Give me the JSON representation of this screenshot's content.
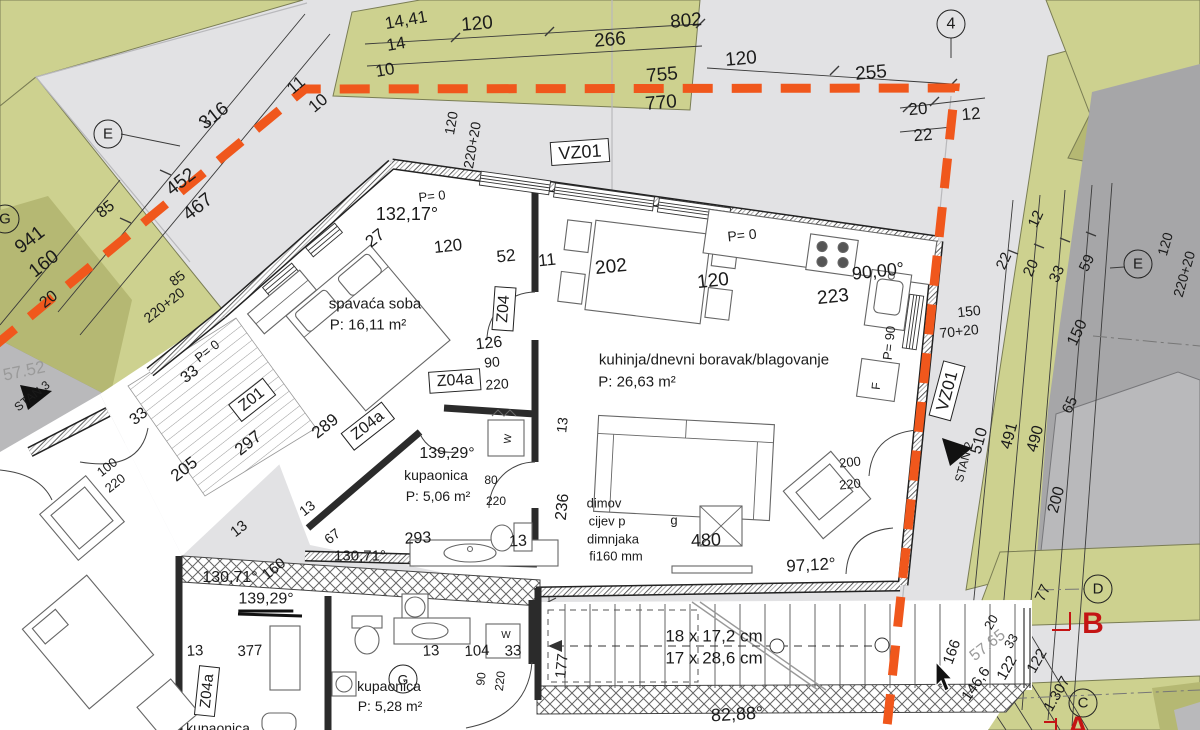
{
  "meta": {
    "drawing_type": "architectural floor plan",
    "cursor_visible": true
  },
  "colors": {
    "boundary_orange": "#f0571c",
    "site_green": "#cdd18f",
    "site_green_dark": "#b5b873",
    "road_dark": "#a6a6a8",
    "building_gray": "#b9b9bb",
    "section_red": "#c41414",
    "paper_gray": "#e2e2e4"
  },
  "rooms": [
    {
      "name": "spavaća soba",
      "area": "P: 16,11 m²"
    },
    {
      "name": "kuhinja/dnevni boravak/blagovanje",
      "area": "P: 26,63 m²"
    },
    {
      "name": "kupaonica",
      "area": "P: 5,06 m²"
    },
    {
      "name": "kupaonica",
      "area": "P: 5,28 m²"
    }
  ],
  "stairs_note": {
    "risers": "18 x 17,2 cm",
    "treads": "17 x 28,6 cm"
  },
  "labels": [
    {
      "id": "dim-14-41",
      "t": "14,41",
      "x": 406,
      "y": 20,
      "r": -10,
      "s": 17
    },
    {
      "id": "dim-14",
      "t": "14",
      "x": 396,
      "y": 44,
      "r": -10,
      "s": 17
    },
    {
      "id": "dim-10-a",
      "t": "10",
      "x": 385,
      "y": 70,
      "r": -10,
      "s": 17
    },
    {
      "id": "dim-10-b",
      "t": "10",
      "x": 318,
      "y": 103,
      "r": -40,
      "s": 17
    },
    {
      "id": "dim-11-a",
      "t": "11",
      "x": 296,
      "y": 85,
      "r": -40,
      "s": 17
    },
    {
      "id": "dim-120-a",
      "t": "120",
      "x": 477,
      "y": 24,
      "r": -5,
      "s": 19
    },
    {
      "id": "dim-266",
      "t": "266",
      "x": 610,
      "y": 40,
      "r": -5,
      "s": 19
    },
    {
      "id": "dim-802",
      "t": "802",
      "x": 686,
      "y": 21,
      "r": -5,
      "s": 19
    },
    {
      "id": "dim-755",
      "t": "755",
      "x": 662,
      "y": 75,
      "r": -5,
      "s": 19
    },
    {
      "id": "dim-770",
      "t": "770",
      "x": 661,
      "y": 103,
      "r": -5,
      "s": 19
    },
    {
      "id": "dim-120-b",
      "t": "120",
      "x": 741,
      "y": 59,
      "r": -5,
      "s": 19
    },
    {
      "id": "dim-255",
      "t": "255",
      "x": 871,
      "y": 73,
      "r": -5,
      "s": 19
    },
    {
      "id": "dim-20-a",
      "t": "20",
      "x": 918,
      "y": 109,
      "r": -5,
      "s": 17
    },
    {
      "id": "dim-12-a",
      "t": "12",
      "x": 971,
      "y": 114,
      "r": -5,
      "s": 17
    },
    {
      "id": "dim-22-a",
      "t": "22",
      "x": 923,
      "y": 135,
      "r": -5,
      "s": 17
    },
    {
      "id": "grid-4",
      "t": "4",
      "x": 951,
      "y": 24,
      "r": 0,
      "s": 16,
      "st": "circ"
    },
    {
      "id": "vz01-top",
      "t": "VZ01",
      "x": 580,
      "y": 152,
      "r": -4,
      "s": 18,
      "st": "box"
    },
    {
      "id": "dim-120-rot-a",
      "t": "120",
      "x": 451,
      "y": 123,
      "r": -80,
      "s": 14
    },
    {
      "id": "dim-220-20-a",
      "t": "220+20",
      "x": 472,
      "y": 145,
      "r": -80,
      "s": 14
    },
    {
      "id": "dim-120-rot-b",
      "t": "120",
      "x": 1165,
      "y": 244,
      "r": -74,
      "s": 14
    },
    {
      "id": "dim-220-20-b",
      "t": "220+20",
      "x": 1184,
      "y": 274,
      "r": -74,
      "s": 14
    },
    {
      "id": "dim-316",
      "t": "316",
      "x": 214,
      "y": 116,
      "r": -38,
      "s": 19
    },
    {
      "id": "dim-452",
      "t": "452",
      "x": 181,
      "y": 182,
      "r": -38,
      "s": 19
    },
    {
      "id": "dim-467",
      "t": "467",
      "x": 198,
      "y": 207,
      "r": -38,
      "s": 19
    },
    {
      "id": "dim-85-a",
      "t": "85",
      "x": 106,
      "y": 210,
      "r": -38,
      "s": 16
    },
    {
      "id": "dim-941",
      "t": "941",
      "x": 30,
      "y": 240,
      "r": -38,
      "s": 19
    },
    {
      "id": "dim-160-a",
      "t": "160",
      "x": 44,
      "y": 264,
      "r": -38,
      "s": 19
    },
    {
      "id": "dim-20-b",
      "t": "20",
      "x": 49,
      "y": 300,
      "r": -38,
      "s": 16
    },
    {
      "id": "dim-85-b",
      "t": "85",
      "x": 177,
      "y": 278,
      "r": -38,
      "s": 14
    },
    {
      "id": "dim-220-20-c",
      "t": "220+20",
      "x": 164,
      "y": 305,
      "r": -38,
      "s": 14
    },
    {
      "id": "grid-E-left",
      "t": "E",
      "x": 108,
      "y": 134,
      "r": 0,
      "s": 15,
      "st": "circ"
    },
    {
      "id": "grid-G-left",
      "t": "G",
      "x": 5,
      "y": 219,
      "r": 0,
      "s": 15,
      "st": "circ"
    },
    {
      "id": "elev-57-52",
      "t": "57.52",
      "x": 24,
      "y": 371,
      "r": -12,
      "s": 17,
      "st": "gray"
    },
    {
      "id": "stan-3",
      "t": "STAN 3",
      "x": 32,
      "y": 396,
      "r": -38,
      "s": 12
    },
    {
      "id": "p0-a",
      "t": "P= 0",
      "x": 207,
      "y": 351,
      "r": -38,
      "s": 13
    },
    {
      "id": "dim-33-a",
      "t": "33",
      "x": 190,
      "y": 375,
      "r": -38,
      "s": 16
    },
    {
      "id": "dim-33-b",
      "t": "33",
      "x": 139,
      "y": 417,
      "r": -38,
      "s": 16
    },
    {
      "id": "z01-box",
      "t": "Z01",
      "x": 252,
      "y": 400,
      "r": -38,
      "s": 16,
      "st": "box"
    },
    {
      "id": "dim-297",
      "t": "297",
      "x": 248,
      "y": 443,
      "r": -38,
      "s": 17
    },
    {
      "id": "dim-205",
      "t": "205",
      "x": 184,
      "y": 469,
      "r": -38,
      "s": 17
    },
    {
      "id": "door-100",
      "t": "100",
      "x": 107,
      "y": 467,
      "r": -38,
      "s": 13
    },
    {
      "id": "door-220",
      "t": "220",
      "x": 115,
      "y": 483,
      "r": -38,
      "s": 13
    },
    {
      "id": "dim-13-a",
      "t": "13",
      "x": 239,
      "y": 529,
      "r": -38,
      "s": 15
    },
    {
      "id": "dim-160-b",
      "t": "160",
      "x": 274,
      "y": 569,
      "r": -38,
      "s": 15
    },
    {
      "id": "ang-130-71-a",
      "t": "130,71°",
      "x": 230,
      "y": 578,
      "r": 0,
      "s": 16
    },
    {
      "id": "ang-139-29-a",
      "t": "139,29°",
      "x": 266,
      "y": 602,
      "r": 0,
      "s": 16,
      "st": "u"
    },
    {
      "id": "p0-b",
      "t": "P= 0",
      "x": 432,
      "y": 196,
      "r": -6,
      "s": 13
    },
    {
      "id": "ang-132-17",
      "t": "132,17°",
      "x": 407,
      "y": 214,
      "r": 0,
      "s": 18
    },
    {
      "id": "dim-27",
      "t": "27",
      "x": 375,
      "y": 238,
      "r": -38,
      "s": 17
    },
    {
      "id": "dim-120-c",
      "t": "120",
      "x": 448,
      "y": 246,
      "r": -6,
      "s": 17
    },
    {
      "id": "dim-52",
      "t": "52",
      "x": 506,
      "y": 256,
      "r": -6,
      "s": 17
    },
    {
      "id": "dim-11-b",
      "t": "11",
      "x": 547,
      "y": 260,
      "r": -6,
      "s": 17
    },
    {
      "id": "room-spavaca",
      "t": "spavaća soba",
      "x": 375,
      "y": 304,
      "r": 0,
      "s": 15
    },
    {
      "id": "room-spavaca-p",
      "t": "P: 16,11 m²",
      "x": 368,
      "y": 325,
      "r": 0,
      "s": 15
    },
    {
      "id": "z04-box",
      "t": "Z04",
      "x": 504,
      "y": 309,
      "r": -86,
      "s": 16,
      "st": "box"
    },
    {
      "id": "dim-126",
      "t": "126",
      "x": 489,
      "y": 344,
      "r": -6,
      "s": 16
    },
    {
      "id": "dim-90-a",
      "t": "90",
      "x": 492,
      "y": 362,
      "r": -6,
      "s": 14
    },
    {
      "id": "z04a-box-a",
      "t": "Z04a",
      "x": 455,
      "y": 381,
      "r": -4,
      "s": 16,
      "st": "box"
    },
    {
      "id": "dim-220-a",
      "t": "220",
      "x": 497,
      "y": 384,
      "r": -4,
      "s": 14
    },
    {
      "id": "dim-289",
      "t": "289",
      "x": 325,
      "y": 426,
      "r": -38,
      "s": 17
    },
    {
      "id": "z04a-box-b",
      "t": "Z04a",
      "x": 368,
      "y": 426,
      "r": -38,
      "s": 16,
      "st": "box"
    },
    {
      "id": "dim-202",
      "t": "202",
      "x": 611,
      "y": 267,
      "r": -6,
      "s": 19
    },
    {
      "id": "dim-120-d",
      "t": "120",
      "x": 713,
      "y": 281,
      "r": -6,
      "s": 19
    },
    {
      "id": "p0-c",
      "t": "P= 0",
      "x": 742,
      "y": 235,
      "r": -6,
      "s": 14
    },
    {
      "id": "ang-90-00",
      "t": "90,00°",
      "x": 878,
      "y": 271,
      "r": -6,
      "s": 18
    },
    {
      "id": "dim-223",
      "t": "223",
      "x": 833,
      "y": 297,
      "r": -6,
      "s": 19
    },
    {
      "id": "room-kuhinja",
      "t": "kuhinja/dnevni boravak/blagovanje",
      "x": 714,
      "y": 360,
      "r": 0,
      "s": 15
    },
    {
      "id": "room-kuhinja-p",
      "t": "P: 26,63 m²",
      "x": 637,
      "y": 382,
      "r": 0,
      "s": 15
    },
    {
      "id": "p90",
      "t": "P= 90",
      "x": 889,
      "y": 343,
      "r": -84,
      "s": 13
    },
    {
      "id": "f-label",
      "t": "F",
      "x": 876,
      "y": 386,
      "r": -84,
      "s": 12
    },
    {
      "id": "dim-13-b",
      "t": "13",
      "x": 562,
      "y": 425,
      "r": -84,
      "s": 14
    },
    {
      "id": "dim-236",
      "t": "236",
      "x": 563,
      "y": 507,
      "r": -84,
      "s": 16
    },
    {
      "id": "note-dimov",
      "t": "dimov",
      "x": 604,
      "y": 503,
      "r": 0,
      "s": 13
    },
    {
      "id": "note-cijev",
      "t": "cijev p",
      "x": 607,
      "y": 521,
      "r": 0,
      "s": 13
    },
    {
      "id": "note-g",
      "t": "g",
      "x": 674,
      "y": 520,
      "r": 0,
      "s": 13
    },
    {
      "id": "note-dimnjaka",
      "t": "dimnjaka",
      "x": 613,
      "y": 539,
      "r": 0,
      "s": 13
    },
    {
      "id": "note-fi160",
      "t": "fi160 mm",
      "x": 616,
      "y": 556,
      "r": 0,
      "s": 13
    },
    {
      "id": "dim-480",
      "t": "480",
      "x": 706,
      "y": 540,
      "r": -3,
      "s": 18
    },
    {
      "id": "ang-97-12",
      "t": "97,12°",
      "x": 811,
      "y": 565,
      "r": -3,
      "s": 17
    },
    {
      "id": "dim-200-a",
      "t": "200",
      "x": 850,
      "y": 462,
      "r": -6,
      "s": 13
    },
    {
      "id": "dim-220-b",
      "t": "220",
      "x": 850,
      "y": 484,
      "r": -6,
      "s": 13
    },
    {
      "id": "ang-139-29-b",
      "t": "139,29°",
      "x": 447,
      "y": 454,
      "r": 0,
      "s": 16
    },
    {
      "id": "room-kupaonica-1",
      "t": "kupaonica",
      "x": 436,
      "y": 475,
      "r": 0,
      "s": 14
    },
    {
      "id": "room-kupaonica-1-p",
      "t": "P: 5,06 m²",
      "x": 438,
      "y": 496,
      "r": 0,
      "s": 14
    },
    {
      "id": "dim-80",
      "t": "80",
      "x": 491,
      "y": 480,
      "r": 0,
      "s": 12
    },
    {
      "id": "dim-220-c",
      "t": "220",
      "x": 496,
      "y": 501,
      "r": 0,
      "s": 12
    },
    {
      "id": "dim-293",
      "t": "293",
      "x": 418,
      "y": 539,
      "r": -3,
      "s": 16
    },
    {
      "id": "dim-13-c",
      "t": "13",
      "x": 518,
      "y": 542,
      "r": -3,
      "s": 16
    },
    {
      "id": "dim-13-d",
      "t": "13",
      "x": 307,
      "y": 508,
      "r": -38,
      "s": 14
    },
    {
      "id": "dim-67",
      "t": "67",
      "x": 332,
      "y": 536,
      "r": -38,
      "s": 14
    },
    {
      "id": "ang-130-71-b",
      "t": "130,71°",
      "x": 360,
      "y": 556,
      "r": 0,
      "s": 15
    },
    {
      "id": "w-a",
      "t": "W",
      "x": 509,
      "y": 439,
      "r": -84,
      "s": 10
    },
    {
      "id": "stairs-risers",
      "t": "18 x 17,2 cm",
      "x": 714,
      "y": 636,
      "r": 0,
      "s": 17
    },
    {
      "id": "stairs-treads",
      "t": "17 x 28,6 cm",
      "x": 714,
      "y": 658,
      "r": 0,
      "s": 17
    },
    {
      "id": "dim-177",
      "t": "177",
      "x": 562,
      "y": 666,
      "r": -84,
      "s": 15
    },
    {
      "id": "dim-13-e",
      "t": "13",
      "x": 195,
      "y": 651,
      "r": -3,
      "s": 15
    },
    {
      "id": "dim-377",
      "t": "377",
      "x": 250,
      "y": 651,
      "r": -3,
      "s": 15
    },
    {
      "id": "z04a-box-c",
      "t": "Z04a",
      "x": 207,
      "y": 691,
      "r": -84,
      "s": 15,
      "st": "box"
    },
    {
      "id": "dim-13-f",
      "t": "13",
      "x": 431,
      "y": 651,
      "r": -3,
      "s": 15
    },
    {
      "id": "dim-104",
      "t": "104",
      "x": 477,
      "y": 651,
      "r": -3,
      "s": 15
    },
    {
      "id": "dim-33-c",
      "t": "33",
      "x": 513,
      "y": 651,
      "r": -3,
      "s": 15
    },
    {
      "id": "dim-90-b",
      "t": "90",
      "x": 481,
      "y": 679,
      "r": -84,
      "s": 12
    },
    {
      "id": "dim-220-d",
      "t": "220",
      "x": 500,
      "y": 681,
      "r": -84,
      "s": 12
    },
    {
      "id": "w-b",
      "t": "W",
      "x": 506,
      "y": 636,
      "r": 0,
      "s": 10
    },
    {
      "id": "g-circle",
      "t": "G",
      "x": 403,
      "y": 679,
      "r": 0,
      "s": 14,
      "st": "circ"
    },
    {
      "id": "room-kupaonica-2",
      "t": "kupaonica",
      "x": 389,
      "y": 686,
      "r": 0,
      "s": 14
    },
    {
      "id": "room-kupaonica-2-p",
      "t": "P: 5,28 m²",
      "x": 390,
      "y": 706,
      "r": 0,
      "s": 14
    },
    {
      "id": "room-kupaonica-3",
      "t": "kupaonica",
      "x": 218,
      "y": 728,
      "r": 0,
      "s": 14
    },
    {
      "id": "ang-82-88",
      "t": "82,88°",
      "x": 737,
      "y": 714,
      "r": -3,
      "s": 18
    },
    {
      "id": "dim-166",
      "t": "166",
      "x": 952,
      "y": 652,
      "r": -70,
      "s": 15
    },
    {
      "id": "elev-57-65",
      "t": "57.65",
      "x": 988,
      "y": 646,
      "r": -38,
      "s": 16,
      "st": "gray"
    },
    {
      "id": "dim-146-6",
      "t": "146,6",
      "x": 976,
      "y": 684,
      "r": -55,
      "s": 15
    },
    {
      "id": "dim-122-a",
      "t": "122",
      "x": 1007,
      "y": 668,
      "r": -60,
      "s": 15
    },
    {
      "id": "dim-122-b",
      "t": "122",
      "x": 1037,
      "y": 661,
      "r": -60,
      "s": 15
    },
    {
      "id": "dim-33-d",
      "t": "33",
      "x": 1011,
      "y": 641,
      "r": -60,
      "s": 13
    },
    {
      "id": "dim-20-c",
      "t": "20",
      "x": 991,
      "y": 622,
      "r": -60,
      "s": 13
    },
    {
      "id": "dim-1-307",
      "t": "1.307",
      "x": 1057,
      "y": 694,
      "r": -60,
      "s": 15
    },
    {
      "id": "grid-D",
      "t": "D",
      "x": 1098,
      "y": 589,
      "r": 0,
      "s": 15,
      "st": "circ"
    },
    {
      "id": "grid-C",
      "t": "C",
      "x": 1083,
      "y": 703,
      "r": 0,
      "s": 15,
      "st": "circ"
    },
    {
      "id": "section-B",
      "t": "B",
      "x": 1093,
      "y": 624,
      "r": 0,
      "s": 30,
      "st": "red"
    },
    {
      "id": "section-A",
      "t": "A",
      "x": 1078,
      "y": 728,
      "r": 0,
      "s": 30,
      "st": "red"
    },
    {
      "id": "dim-77",
      "t": "77",
      "x": 1043,
      "y": 593,
      "r": -65,
      "s": 15
    },
    {
      "id": "dim-200-b",
      "t": "200",
      "x": 1057,
      "y": 500,
      "r": -75,
      "s": 16
    },
    {
      "id": "dim-510",
      "t": "510",
      "x": 980,
      "y": 441,
      "r": -75,
      "s": 16
    },
    {
      "id": "dim-491",
      "t": "491",
      "x": 1010,
      "y": 436,
      "r": -75,
      "s": 16
    },
    {
      "id": "dim-490",
      "t": "490",
      "x": 1036,
      "y": 439,
      "r": -75,
      "s": 16
    },
    {
      "id": "stan-2",
      "t": "STAN 2",
      "x": 964,
      "y": 462,
      "r": -75,
      "s": 12
    },
    {
      "id": "vz01-right",
      "t": "VZ01",
      "x": 947,
      "y": 391,
      "r": -75,
      "s": 17,
      "st": "box"
    },
    {
      "id": "dim-150-a",
      "t": "150",
      "x": 969,
      "y": 311,
      "r": -6,
      "s": 14
    },
    {
      "id": "dim-70-20",
      "t": "70+20",
      "x": 959,
      "y": 331,
      "r": -6,
      "s": 14
    },
    {
      "id": "dim-22-b",
      "t": "22",
      "x": 1004,
      "y": 261,
      "r": -65,
      "s": 15
    },
    {
      "id": "dim-12-b",
      "t": "12",
      "x": 1036,
      "y": 219,
      "r": -65,
      "s": 15
    },
    {
      "id": "dim-20-d",
      "t": "20",
      "x": 1031,
      "y": 268,
      "r": -65,
      "s": 15
    },
    {
      "id": "dim-33-e",
      "t": "33",
      "x": 1057,
      "y": 274,
      "r": -65,
      "s": 15
    },
    {
      "id": "dim-59",
      "t": "59",
      "x": 1087,
      "y": 263,
      "r": -65,
      "s": 15
    },
    {
      "id": "dim-150-b",
      "t": "150",
      "x": 1078,
      "y": 333,
      "r": -65,
      "s": 16
    },
    {
      "id": "dim-65",
      "t": "65",
      "x": 1070,
      "y": 405,
      "r": -65,
      "s": 15
    },
    {
      "id": "grid-E-right",
      "t": "E",
      "x": 1138,
      "y": 264,
      "r": 0,
      "s": 15,
      "st": "circ"
    }
  ]
}
